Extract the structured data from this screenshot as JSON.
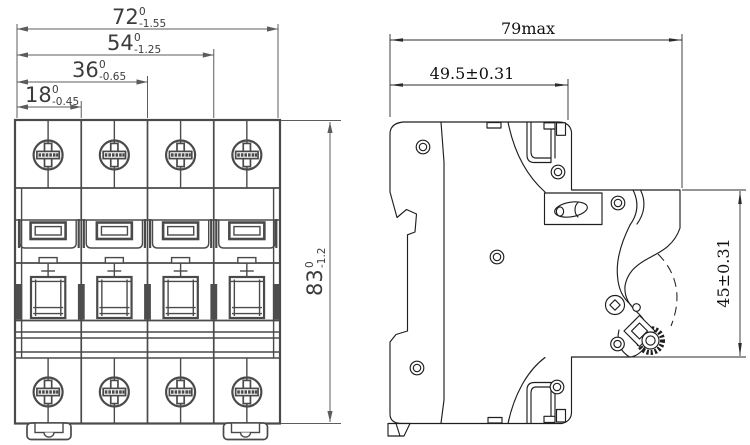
{
  "drawing": {
    "type": "engineering-dimension-drawing",
    "subject": "4-pole miniature circuit breaker",
    "views": [
      "front view",
      "side view"
    ]
  },
  "front_view": {
    "dimensions": {
      "width_total": {
        "value": "72",
        "tol_upper": "0",
        "tol_lower": "-1.55"
      },
      "width_three_poles": {
        "value": "54",
        "tol_upper": "0",
        "tol_lower": "-1.25"
      },
      "width_two_poles": {
        "value": "36",
        "tol_upper": "0",
        "tol_lower": "-0.65"
      },
      "width_one_pole": {
        "value": "18",
        "tol_upper": "0",
        "tol_lower": "-0.45"
      },
      "height_total": {
        "value": "83",
        "tol_upper": "0",
        "tol_lower": "-1.2"
      }
    }
  },
  "side_view": {
    "dimensions": {
      "depth_max": {
        "value": "79max"
      },
      "body_depth": {
        "value": "49.5±0.31"
      },
      "front_face_height": {
        "value": "45±0.31"
      }
    }
  },
  "colors": {
    "background": "#ffffff",
    "front_view_line": "#4a4a4a",
    "side_view_line": "#1f1f1f",
    "dimension_line": "#5c5c5c",
    "text": "#3c3c3c"
  }
}
